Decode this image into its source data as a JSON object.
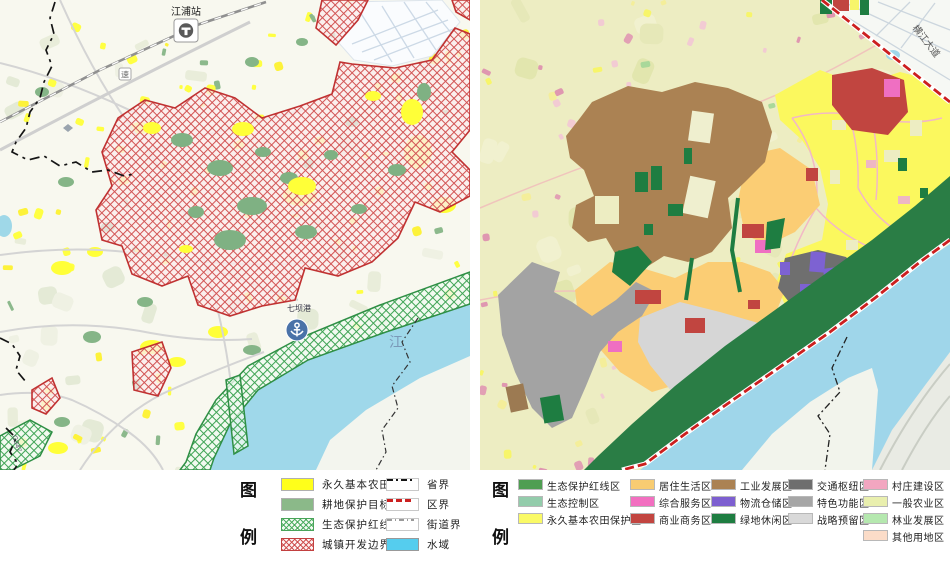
{
  "left_map": {
    "labels": {
      "station": "江浦站",
      "river": "江",
      "port": "七坝港",
      "road_shield": "速",
      "road_number": "G347"
    },
    "legend": {
      "title_chars": [
        "图",
        "例"
      ],
      "area_items": [
        {
          "label": "永久基本农田",
          "color": "#ffff1a",
          "pattern": "solid"
        },
        {
          "label": "耕地保护目标",
          "color": "#8bb989",
          "pattern": "solid"
        },
        {
          "label": "生态保护红线",
          "color": "#4aa45a",
          "pattern": "green-hatch"
        },
        {
          "label": "城镇开发边界",
          "color": "#c24040",
          "pattern": "red-hatch"
        }
      ],
      "line_items": [
        {
          "label": "省界",
          "style": "black-dash"
        },
        {
          "label": "区界",
          "style": "red-dash"
        },
        {
          "label": "街道界",
          "style": "gray-dashdot"
        },
        {
          "label": "水域",
          "style": "solid-fill",
          "color": "#55cdee"
        }
      ]
    }
  },
  "right_map": {
    "labels": {
      "road": "横江大道"
    },
    "legend": {
      "title_chars": [
        "图",
        "例"
      ],
      "columns": [
        [
          {
            "label": "生态保护红线区",
            "color": "#4f9e52"
          },
          {
            "label": "生态控制区",
            "color": "#93ccab"
          },
          {
            "label": "永久基本农田保护区",
            "color": "#fafa66"
          }
        ],
        [
          {
            "label": "居住生活区",
            "color": "#f8cc72"
          },
          {
            "label": "综合服务区",
            "color": "#f26fc0"
          },
          {
            "label": "商业商务区",
            "color": "#c24540"
          }
        ],
        [
          {
            "label": "工业发展区",
            "color": "#ab8253"
          },
          {
            "label": "物流仓储区",
            "color": "#7d5fd0"
          },
          {
            "label": "绿地休闲区",
            "color": "#1e7d41"
          }
        ],
        [
          {
            "label": "交通枢纽区",
            "color": "#6e6e6e"
          },
          {
            "label": "特色功能区",
            "color": "#a6a6a6"
          },
          {
            "label": "战略预留区",
            "color": "#d9d9d9"
          }
        ],
        [
          {
            "label": "村庄建设区",
            "color": "#f2a6c0"
          },
          {
            "label": "一般农业区",
            "color": "#e9efae"
          },
          {
            "label": "林业发展区",
            "color": "#b5e8af"
          },
          {
            "label": "其他用地区",
            "color": "#fbdcc8"
          }
        ]
      ]
    }
  }
}
